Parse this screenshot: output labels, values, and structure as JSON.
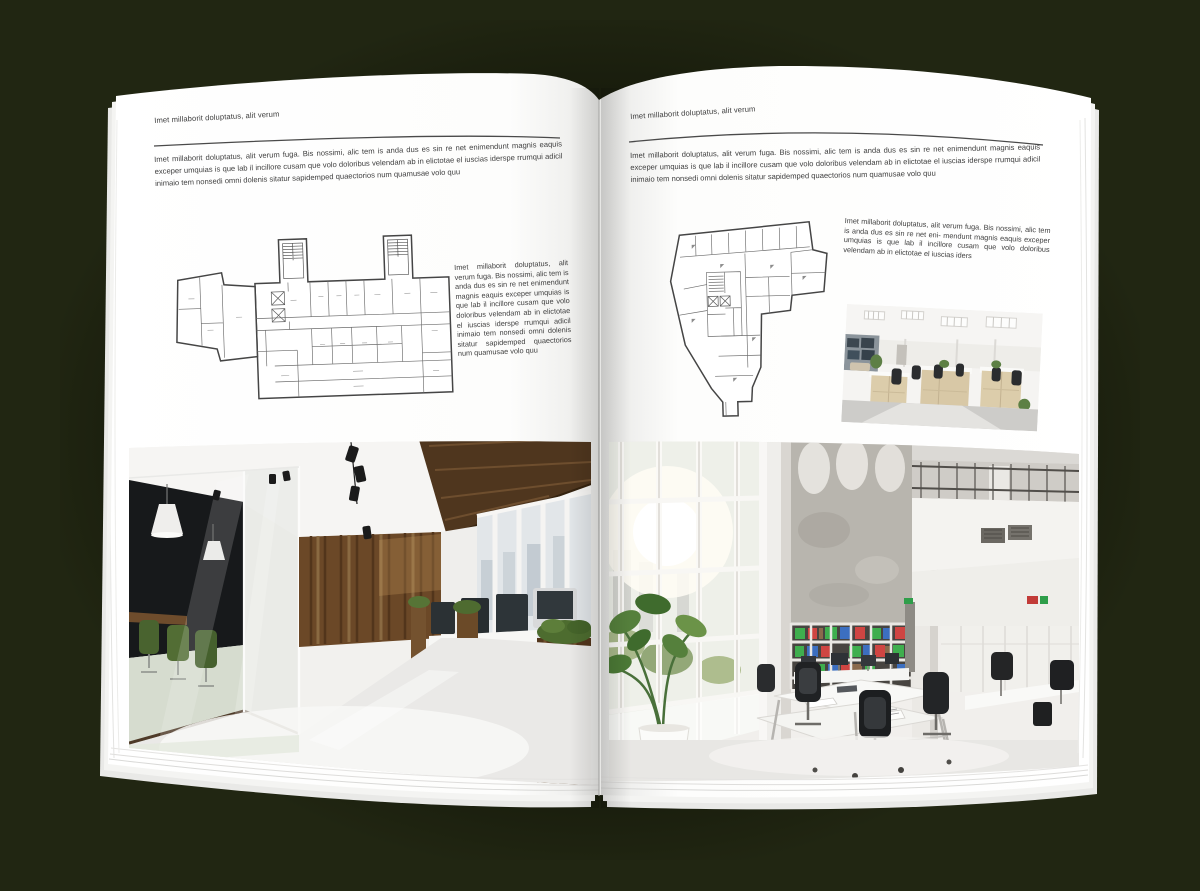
{
  "canvas": {
    "background_color": "#212612",
    "page_color": "#ffffff",
    "text_color": "#3e3e3e",
    "rule_color": "#4a4a4a"
  },
  "left_page": {
    "header": "Imet millaborit doluptatus, alit verum",
    "intro": "Imet millaborit doluptatus, alit verum fuga. Bis nossimi, alic tem is anda dus es sin re net enimendunt magnis eaquis exceper umquias is que lab il incillore cusam que volo doloribus velendam ab in elictotae el iuscias iderspe rrumqui adicil inimaio tem nonsedi omni dolenis sitatur sapidemped quaectorios num quamusae volo quu",
    "side_text": "Imet millaborit doluptatus, alit verum fuga. Bis nossimi, alic tem is anda dus es sin re net enimendunt magnis eaquis exceper umquias is que lab il incillore cusam que volo doloribus velendam ab in elictotae el iuscias iderspe rrumqui adicil inimaio tem nonsedi omni dolenis sitatur sapidemped quaectorios num quamusae volo quu",
    "floor_plan_label": "architectural floor plan of elongated office building with two stair towers",
    "photo_label": "modern office interior with dark glass meeting room, wooden plank wall and workstations"
  },
  "right_page": {
    "header": "Imet millaborit doluptatus, alit verum",
    "intro": "Imet millaborit doluptatus, alit verum fuga. Bis nossimi, alic tem is anda dus es sin re net enimendunt magnis eaquis exceper umquias is que lab il incillore cusam que volo doloribus velendam ab in elictotae el iuscias iderspe rrumqui adicil inimaio tem nonsedi omni dolenis sitatur sapidemped quaectorios num quamusae volo quu",
    "side_text": "Imet millaborit doluptatus, alit verum fuga. Bis nossimi, alic tem is anda dus es sin re net eni- mendunt magnis eaquis exceper umquias is que lab il incillore cusam que volo doloribus velendam ab in elictotae el iuscias iders",
    "floor_plan_label": "architectural floor plan of irregular tapering office building",
    "small_photo_label": "open plan office with light wood workstation cabinets",
    "photo_label": "double height office atrium with concrete wall, binder bookshelf and white desks"
  }
}
